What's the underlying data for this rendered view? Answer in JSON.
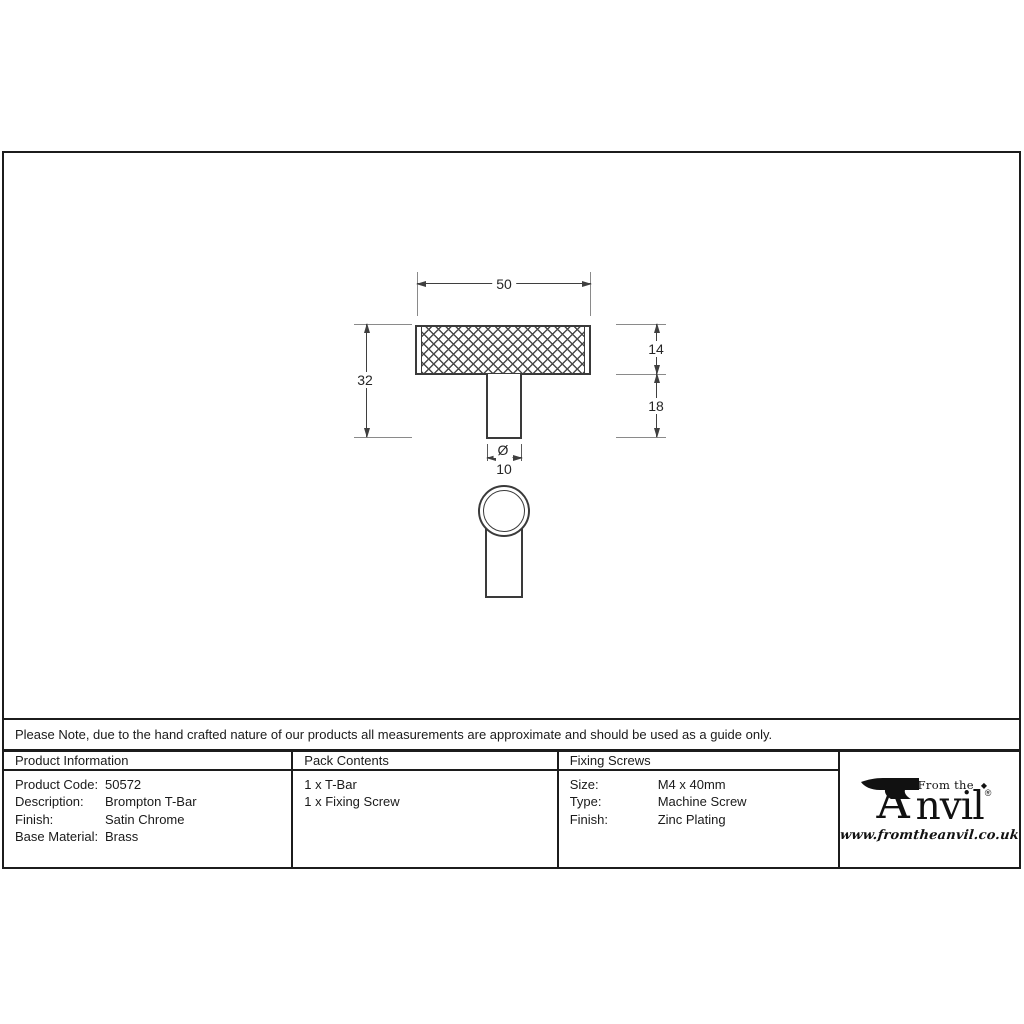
{
  "drawing": {
    "dims": {
      "width": "50",
      "height": "32",
      "bar_height": "14",
      "stem_height": "18",
      "diameter_symbol": "Ø",
      "diameter": "10"
    }
  },
  "note": "Please Note, due to the hand crafted nature of our products all measurements are approximate and should be used as a guide only.",
  "table": {
    "product_info": {
      "header": "Product Information",
      "rows": [
        {
          "label": "Product Code:",
          "value": "50572"
        },
        {
          "label": "Description:",
          "value": "Brompton T-Bar"
        },
        {
          "label": "Finish:",
          "value": "Satin Chrome"
        },
        {
          "label": "Base Material:",
          "value": "Brass"
        }
      ]
    },
    "pack_contents": {
      "header": "Pack Contents",
      "items": [
        "1 x T-Bar",
        "1 x Fixing Screw"
      ]
    },
    "fixing_screws": {
      "header": "Fixing Screws",
      "rows": [
        {
          "label": "Size:",
          "value": "M4 x 40mm"
        },
        {
          "label": "Type:",
          "value": "Machine Screw"
        },
        {
          "label": "Finish:",
          "value": "Zinc Plating"
        }
      ]
    }
  },
  "logo": {
    "prefix": "From the",
    "diamond": "◆",
    "brand_initial": "A",
    "brand_rest": "nvil",
    "registered": "®",
    "url": "www.fromtheanvil.co.uk",
    "ink_color": "#111111"
  },
  "colors": {
    "line": "#3a3a3a",
    "extension_line": "#8a8a8a",
    "border": "#1c1c1c"
  }
}
